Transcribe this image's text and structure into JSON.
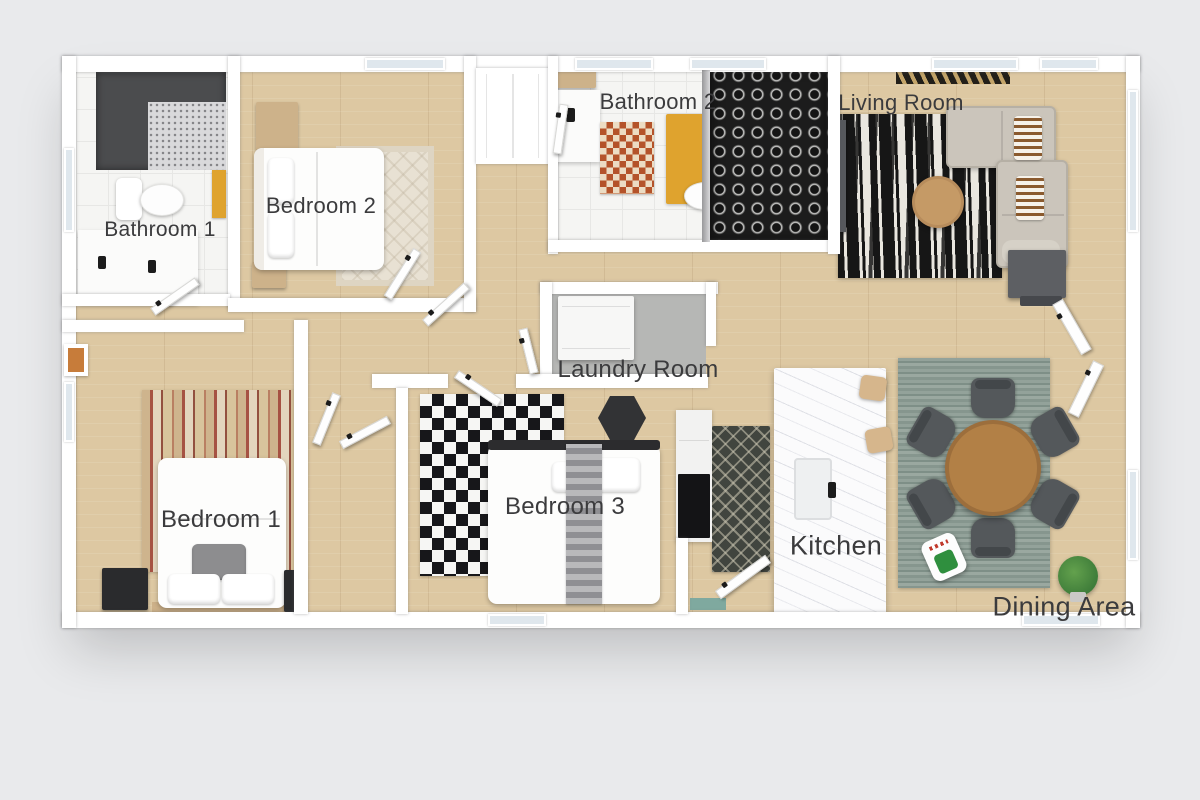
{
  "rooms": [
    {
      "id": "bathroom-1",
      "label": "Bathroom 1"
    },
    {
      "id": "bedroom-2",
      "label": "Bedroom 2"
    },
    {
      "id": "bathroom-2",
      "label": "Bathroom 2"
    },
    {
      "id": "living-room",
      "label": "Living Room"
    },
    {
      "id": "laundry-room",
      "label": "Laundry Room"
    },
    {
      "id": "bedroom-1",
      "label": "Bedroom 1"
    },
    {
      "id": "bedroom-3",
      "label": "Bedroom 3"
    },
    {
      "id": "kitchen",
      "label": "Kitchen"
    },
    {
      "id": "dining-area",
      "label": "Dining Area"
    }
  ],
  "colors": {
    "bg": "#e9eaec",
    "wall": "#ffffff",
    "wood": "#ddc8a2",
    "tile": "#f5f5f3",
    "label": "#3b3b3d",
    "laundry-floor": "#b6b7b5",
    "shower-dark": "#4b4c4e",
    "sofa": "#cbc5bb",
    "coffee-table": "#c59a66",
    "table-wood": "#b28046",
    "chair": "#54585b",
    "island": "#fbfbfc",
    "mat-orange": "#b4532a",
    "mat-yellow": "#dfa32e",
    "dark-furniture": "#2a2b2d"
  }
}
